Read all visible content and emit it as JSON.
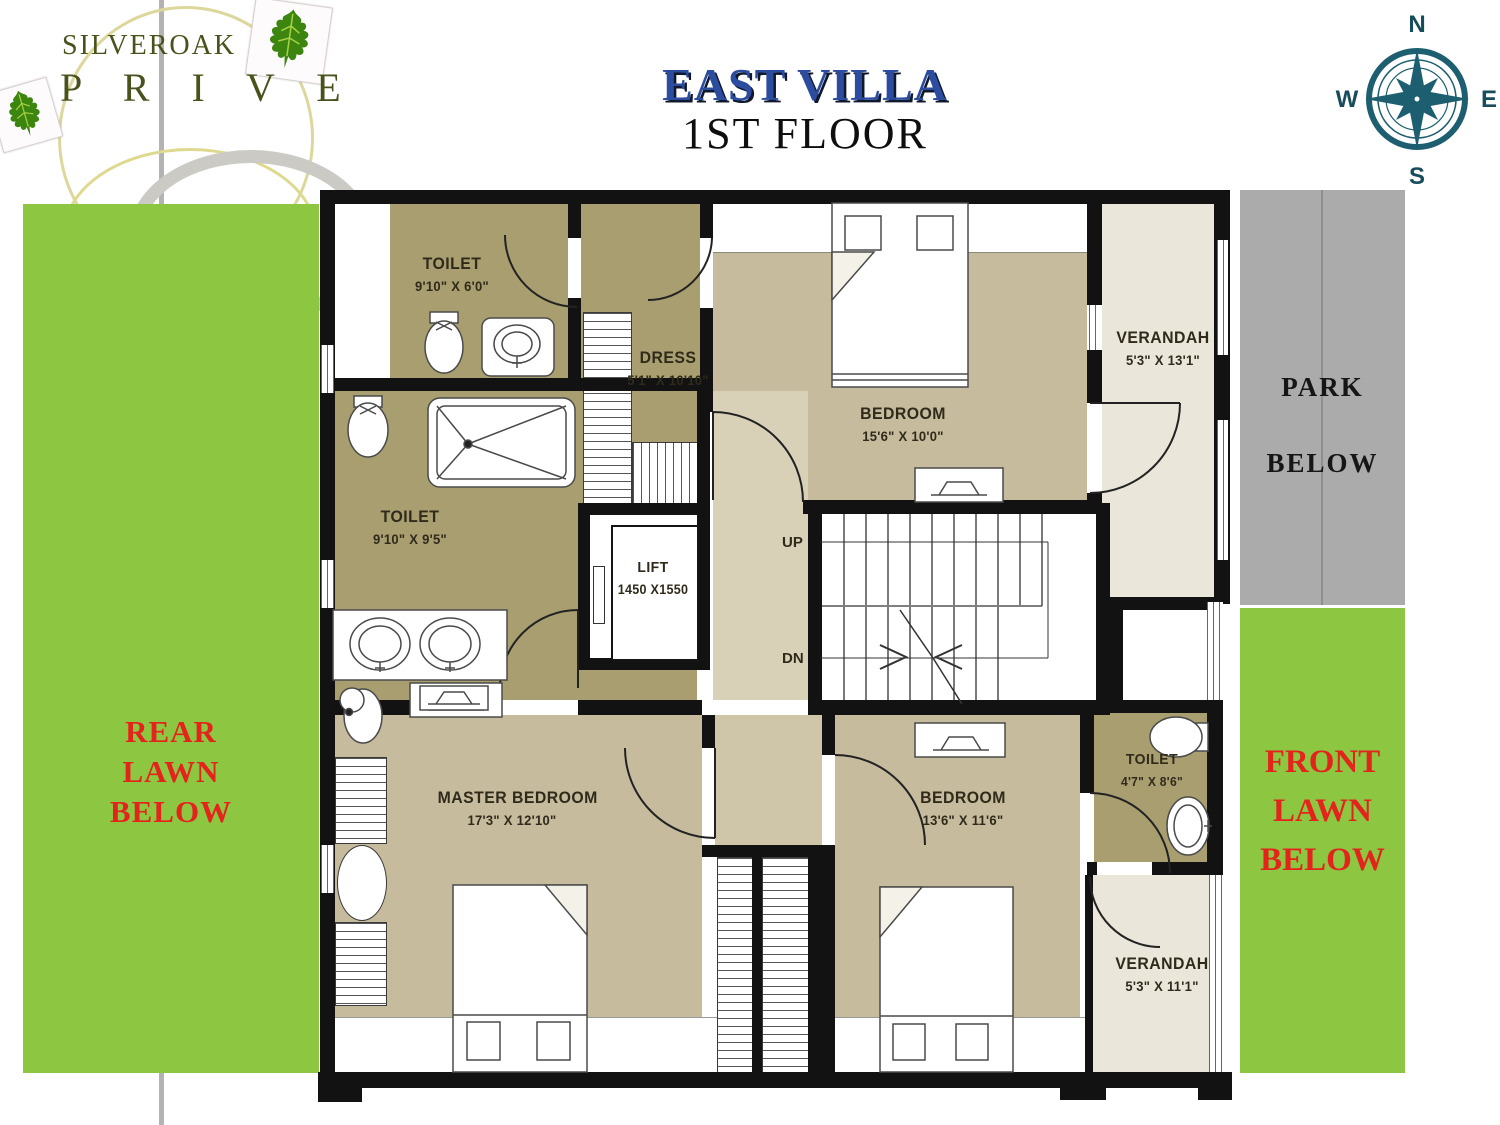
{
  "logo": {
    "name": "SILVEROAK",
    "sub": "P R I V E"
  },
  "title": {
    "main": "EAST VILLA",
    "floor": "1ST FLOOR"
  },
  "compass": {
    "north": "N",
    "east": "E",
    "south": "S",
    "west": "W"
  },
  "lawns": {
    "rear": [
      "REAR",
      "LAWN",
      "BELOW"
    ],
    "park": [
      "PARK",
      "BELOW"
    ],
    "front": [
      "FRONT",
      "LAWN",
      "BELOW"
    ]
  },
  "rooms": [
    {
      "id": "toilet-top",
      "name": "TOILET",
      "dims": "9'10\" X 6'0\""
    },
    {
      "id": "dress",
      "name": "DRESS",
      "dims": "5'1\" X 10'10\""
    },
    {
      "id": "bedroom-top",
      "name": "BEDROOM",
      "dims": "15'6\" X 10'0\""
    },
    {
      "id": "verandah-top",
      "name": "VERANDAH",
      "dims": "5'3\" X 13'1\""
    },
    {
      "id": "toilet-mid",
      "name": "TOILET",
      "dims": "9'10\" X 9'5\""
    },
    {
      "id": "lift",
      "name": "LIFT",
      "dims": "1450 X1550"
    },
    {
      "id": "master-bedroom",
      "name": "MASTER BEDROOM",
      "dims": "17'3\" X 12'10\""
    },
    {
      "id": "bedroom-right",
      "name": "BEDROOM",
      "dims": "13'6\" X 11'6\""
    },
    {
      "id": "toilet-right",
      "name": "TOILET",
      "dims": "4'7\" X 8'6\""
    },
    {
      "id": "verandah-bottom",
      "name": "VERANDAH",
      "dims": "5'3\" X 11'1\""
    }
  ],
  "stairs": {
    "up": "UP",
    "down": "DN"
  },
  "colors": {
    "title_blue": "#2b4c9f",
    "lawn_green": "#8dc742",
    "annotation_red": "#e3231c",
    "park_gray": "#ababab",
    "wall_black": "#121212",
    "toilet_khaki": "#a89e70",
    "bedroom_tan": "#c7bb9e",
    "verandah_cream": "#eae6d9",
    "compass_teal": "#1d5f70",
    "logo_green": "#49521c"
  }
}
